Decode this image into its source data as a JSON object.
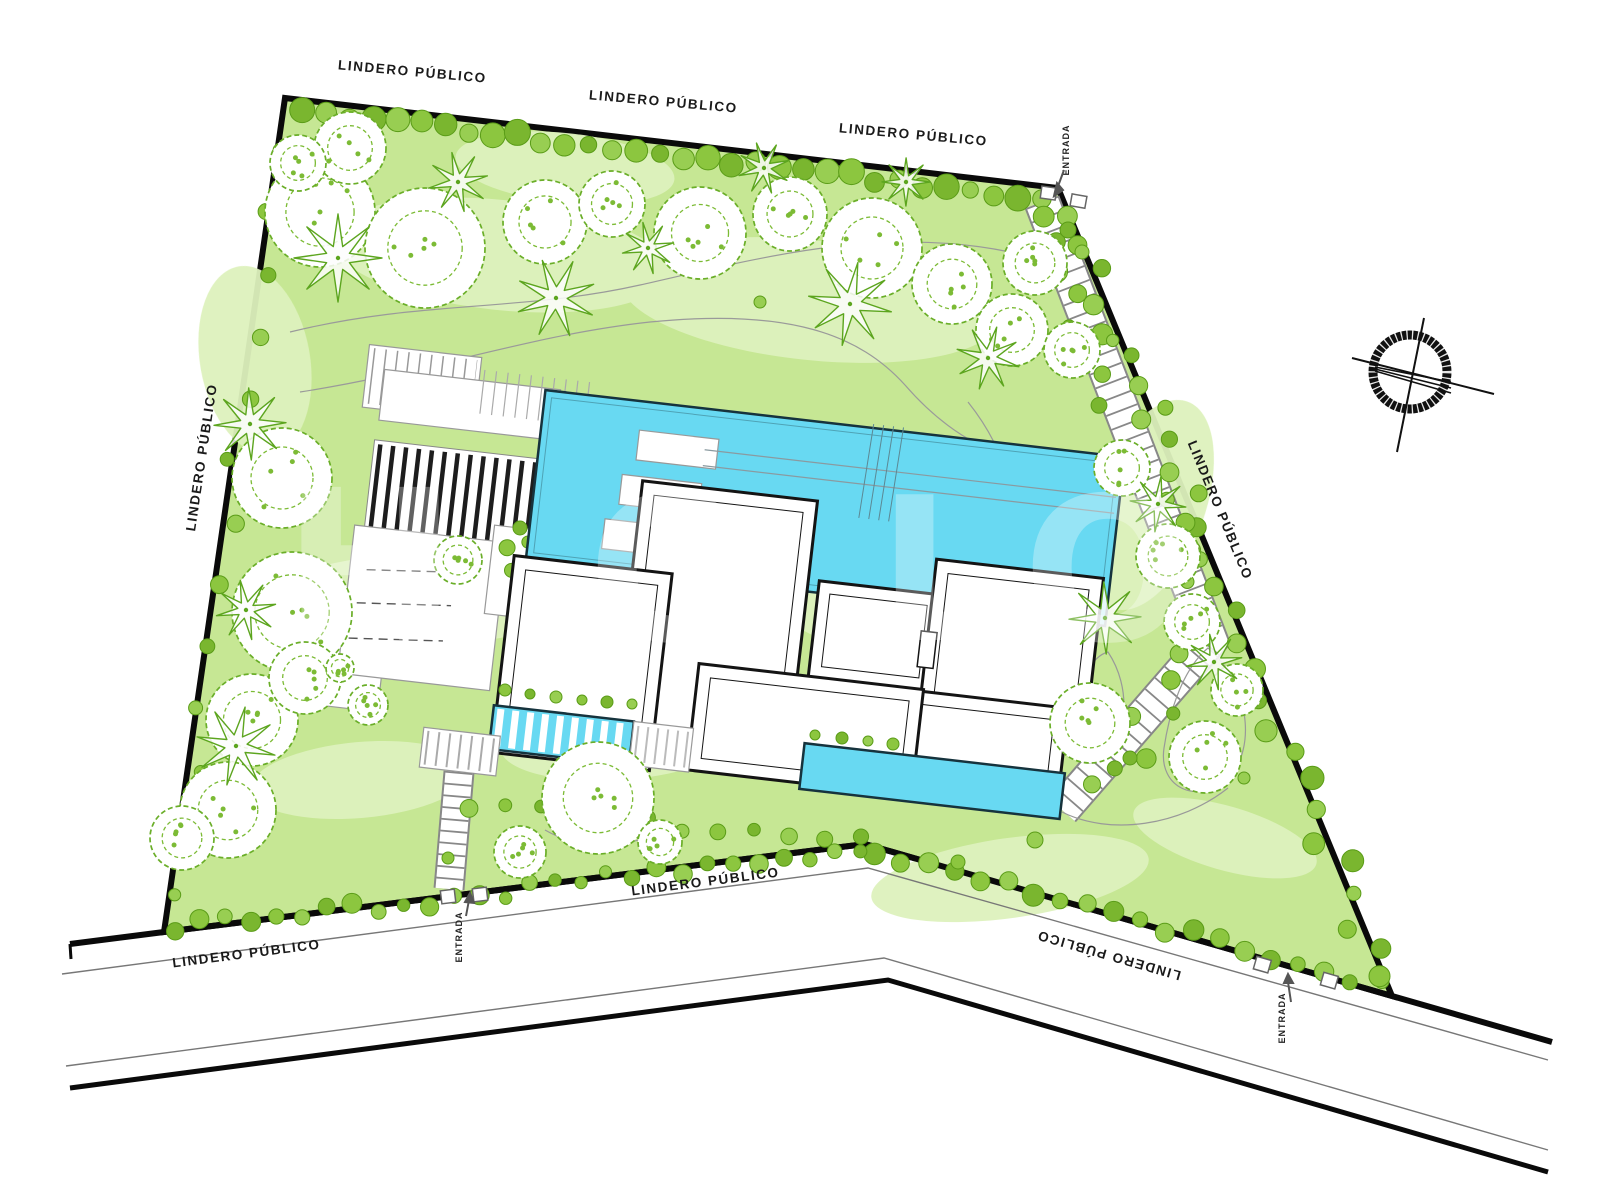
{
  "page": {
    "background": "#ffffff"
  },
  "labels": {
    "lindero_publico": "LINDERO PÚBLICO",
    "entrada": "ENTRADA"
  },
  "label_instances": {
    "boundary": [
      "top-left",
      "top-center",
      "top-right",
      "left",
      "right",
      "bottom-inside",
      "bottom-left",
      "bottom-right-road"
    ],
    "entrances": [
      "north-east",
      "south-west",
      "south-east"
    ]
  },
  "watermark": {
    "fragment_1": "H",
    "fragment_2": "O LOV"
  },
  "colors": {
    "grass": "#c6e794",
    "grass_light": "#def2bd",
    "pool_water": "#68d9f2",
    "tree_green": "#6aae28",
    "shrub_green": "#8cc63f",
    "boundary_black": "#0a0a0a",
    "road_line_gray": "#777777",
    "wall_black": "#141414",
    "label_black": "#1a1a1a"
  },
  "icons": {
    "compass": "north-compass-icon",
    "entrance_arrow": "entrance-arrow-icon"
  }
}
